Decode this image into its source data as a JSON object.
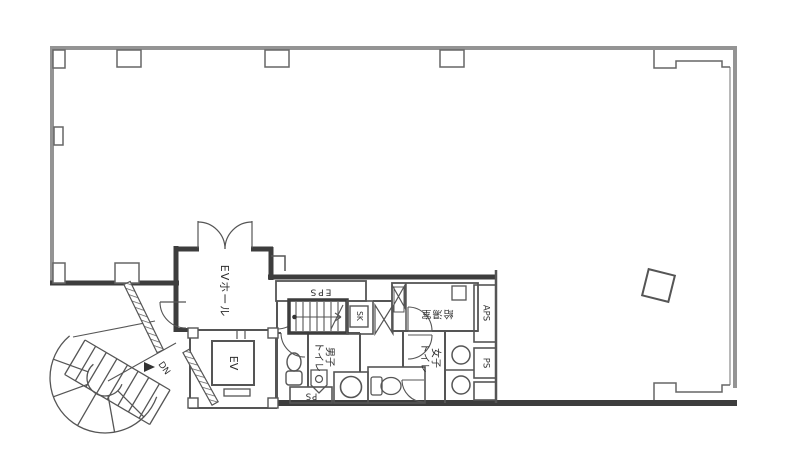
{
  "floorplan": {
    "rooms": {
      "elevator_hall": "EVホール",
      "elevator": "EV",
      "eps": "EPS",
      "sk": "SK",
      "mens_toilet": [
        "男子",
        "トイレ"
      ],
      "womens_toilet": [
        "女子",
        "トイレ"
      ],
      "kitchenette": "給湯室",
      "aps": "APS",
      "ps_upper": "PS",
      "ps_lower": "PS",
      "stairs_down": "DN"
    },
    "colors": {
      "wall_dark": "#3d3d3d",
      "wall_gray": "#949494",
      "line": "#555555",
      "background": "#ffffff"
    }
  }
}
